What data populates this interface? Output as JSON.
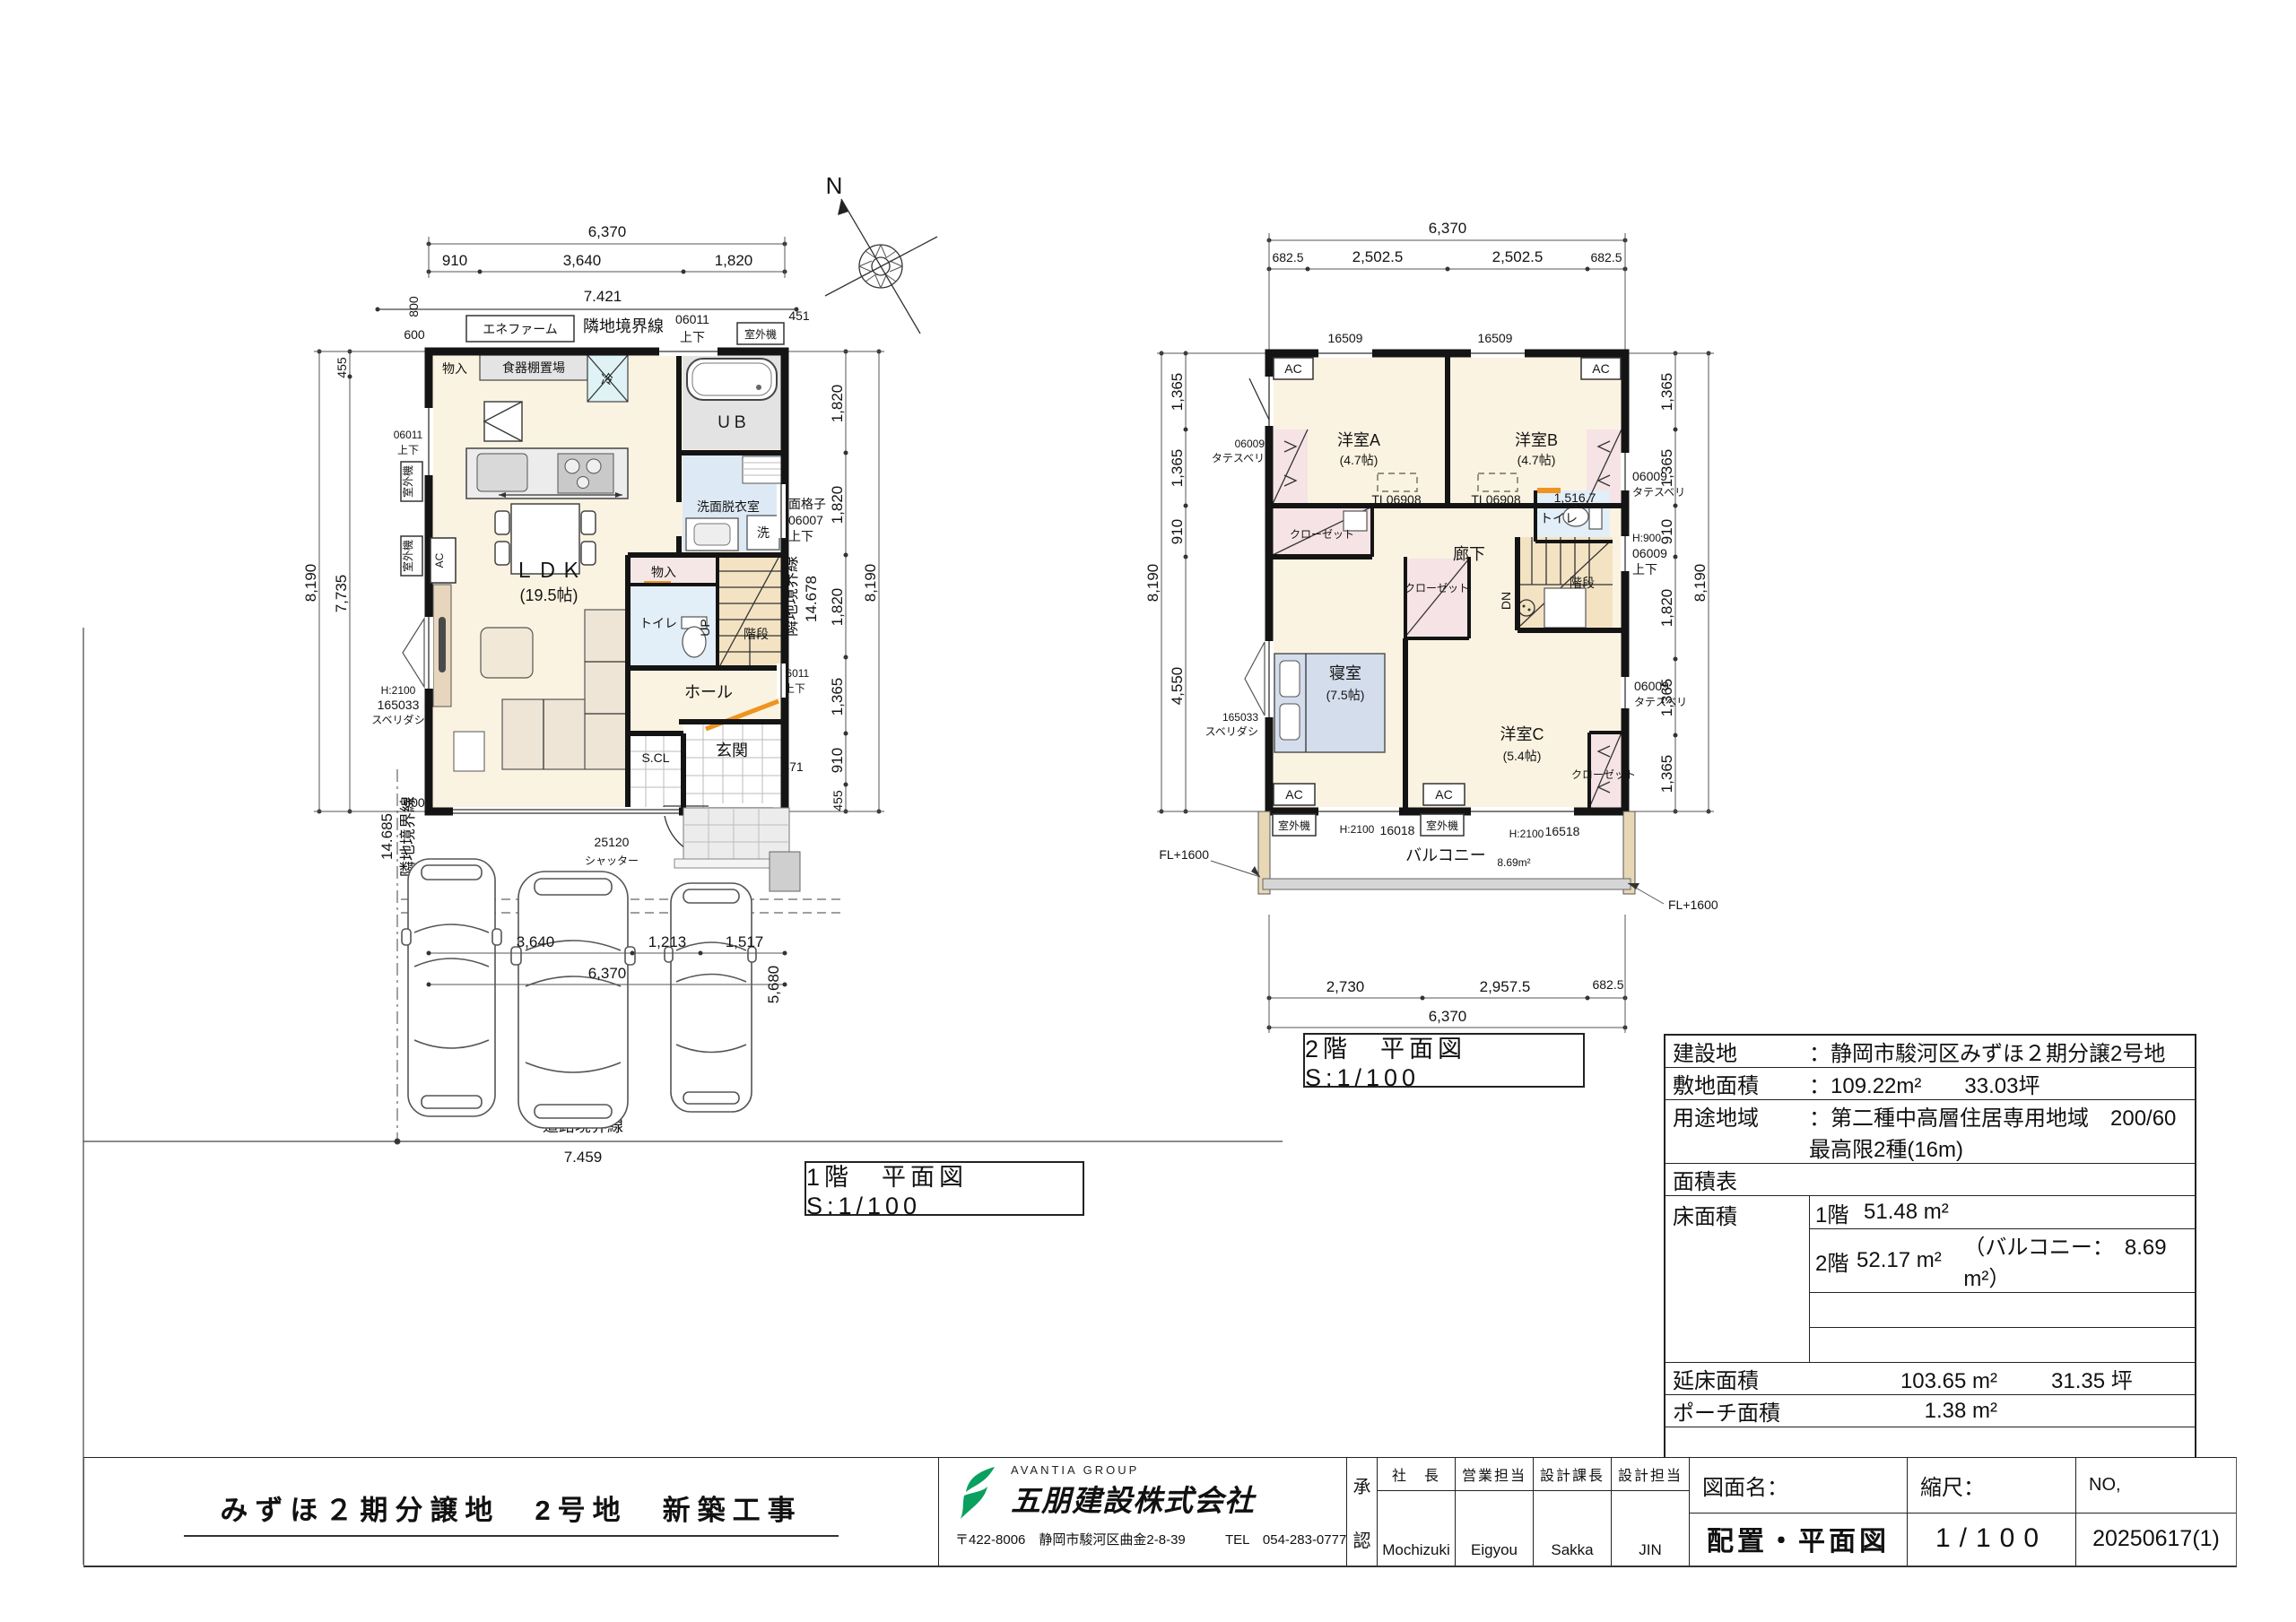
{
  "captions": {
    "f1": "1階　平面図 S:1/100",
    "f2": "2階　平面図 S:1/100"
  },
  "compass": {
    "north": "N"
  },
  "dims": {
    "a6370": "6,370",
    "a910": "910",
    "a3640": "3,640",
    "a1820": "1,820",
    "a7421": "7.421",
    "a800": "800",
    "a600": "600",
    "a455": "455",
    "a8190": "8,190",
    "a7735": "7,735",
    "a1365": "1,365",
    "a451": "451",
    "a471": "471",
    "a14678": "14.678",
    "a14685": "14.685",
    "a5695": "5,695.5",
    "a5680": "5,680",
    "a7459": "7.459",
    "a1213": "1,213",
    "a1517": "1,517",
    "a25120": "25120",
    "a6825": "682.5",
    "a25025": "2,502.5",
    "a2730": "2,730",
    "a29575": "2,957.5",
    "a4550": "4,550",
    "a15167": "1,516.7",
    "a16509": "16509",
    "a16018": "16018",
    "a16518": "16518"
  },
  "marks": {
    "rinchi": "隣地境界線",
    "doro": "道路境界線",
    "shitsugaiki": "室外機",
    "ac": "AC",
    "jouge": "上下",
    "w06011": "06011",
    "w06009": "06009",
    "w06007": "06007",
    "mengoshi": "面格子",
    "tate": "タテスベリ",
    "sube": "スベリダシ",
    "w165033": "165033",
    "h2100": "H:2100",
    "h900": "H:900",
    "tl06908": "TL06908",
    "enefarm": "エネファーム",
    "shutter": "シャッター",
    "fl1600": "FL+1600",
    "up": "UP",
    "dn": "DN",
    "kaidan": "階段",
    "closet": "クローゼット"
  },
  "rooms1": {
    "monoire": "物入",
    "shokkidana": "食器棚置場",
    "rei": "冷",
    "ub": "ＵＢ",
    "senmen": "洗面脱衣室",
    "sentaku": "洗",
    "monoire2": "物入",
    "toilet": "トイレ",
    "ldk": "ＬＤＫ",
    "ldk_size": "(19.5帖)",
    "hall": "ホール",
    "scl": "S.CL",
    "genkan": "玄関"
  },
  "rooms2": {
    "yoshitsuA": "洋室A",
    "yoshitsuA_size": "(4.7帖)",
    "yoshitsuB": "洋室B",
    "yoshitsuB_size": "(4.7帖)",
    "shinshitsu": "寝室",
    "shinshitsu_size": "(7.5帖)",
    "yoshitsuC": "洋室C",
    "yoshitsuC_size": "(5.4帖)",
    "rouka": "廊下",
    "toilet": "トイレ",
    "balcony": "バルコニー",
    "balcony_area": "8.69m²"
  },
  "info": {
    "kensetsuchi_label": "建設地",
    "kensetsuchi_value": "：静岡市駿河区みずほ２期分譲2号地",
    "shikichi_label": "敷地面積",
    "shikichi_value": "：109.22m²　　33.03坪",
    "yoto_label": "用途地域",
    "yoto_value": "：第二種中高層住居専用地域　200/60",
    "yoto_value2": "最高限2種(16m)",
    "mensekihyo": "面積表",
    "yuka_label": "床面積",
    "yuka_1f_floor": "1階",
    "yuka_1f_value": "51.48 m²",
    "yuka_2f_floor": "2階",
    "yuka_2f_value": "52.17 m²",
    "yuka_2f_note": "（バルコニー：　8.69　m²）",
    "nobeyuka_label": "延床面積",
    "nobeyuka_m2": "103.65 m²",
    "nobeyuka_tsubo": "31.35 坪",
    "porch_label": "ポーチ面積",
    "porch_m2": "1.38 m²",
    "sekou_label": "施工床面積",
    "sekou_m2": "105.03 m²",
    "sekou_tsubo": "31.77 坪",
    "note": "∴図面は基本仕様と追加仕様にて作成してあります。"
  },
  "title_block": {
    "project": "みずほ２期分譲地　2号地　新築工事",
    "group": "AVANTIA GROUP",
    "company": "五朋建設株式会社",
    "address": "〒422-8006　静岡市駿河区曲金2-8-39",
    "tel": "TEL　054-283-0777",
    "approval_top": "承",
    "approval_bottom": "認",
    "col1_title": "社　長",
    "col1_name": "Mochizuki",
    "col2_title": "営業担当",
    "col2_name": "Eigyou",
    "col3_title": "設計課長",
    "col3_name": "Sakka",
    "col4_title": "設計担当",
    "col4_name": "JIN",
    "zumen_label": "図面名：",
    "zumen_value": "配置・平面図",
    "scale_label": "縮尺：",
    "scale_value": "1/100",
    "no_label": "NO,",
    "no_value": "20250617(1)"
  }
}
